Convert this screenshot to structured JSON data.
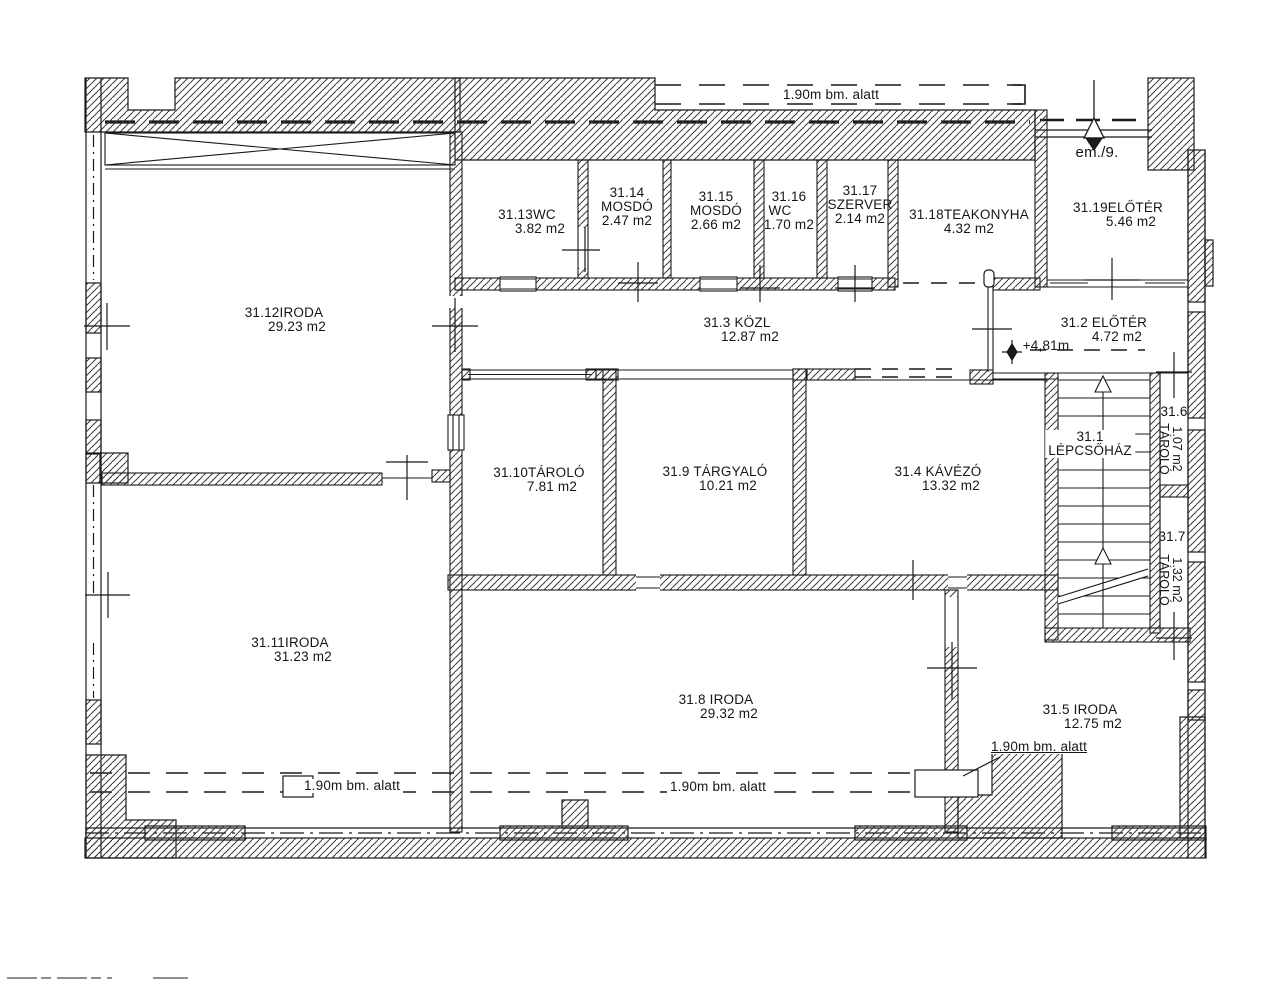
{
  "plan": {
    "rooms": [
      {
        "line1": "31.12IRODA",
        "area": "29.23 m2"
      },
      {
        "line1": "31.13WC",
        "area": "3.82 m2"
      },
      {
        "line1": "31.14",
        "line2": "MOSDÓ",
        "area": "2.47 m2"
      },
      {
        "line1": "31.15",
        "line2": "MOSDÓ",
        "area": "2.66 m2"
      },
      {
        "line1": "31.16",
        "line2": "WC",
        "area": "1.70 m2"
      },
      {
        "line1": "31.17",
        "line2": "SZERVER",
        "area": "2.14 m2"
      },
      {
        "line1": "31.18TEAKONYHA",
        "area": "4.32 m2"
      },
      {
        "line1": "31.19ELŐTÉR",
        "area": "5.46 m2"
      },
      {
        "line1": "31.3 KÖZL",
        "area": "12.87 m2"
      },
      {
        "line1": "31.2 ELŐTÉR",
        "area": "4.72 m2"
      },
      {
        "line1": "31.10TÁROLÓ",
        "area": "7.81 m2"
      },
      {
        "line1": "31.9 TÁRGYALÓ",
        "area": "10.21 m2"
      },
      {
        "line1": "31.4 KÁVÉZÓ",
        "area": "13.32 m2"
      },
      {
        "line1": "31.1",
        "line2": "LÉPCSŐHÁZ"
      },
      {
        "line1": "31.6",
        "name": "TÁROLÓ",
        "area": "1.07 m2"
      },
      {
        "line1": "31.7",
        "name": "TÁROLÓ",
        "area": "1.32 m2"
      },
      {
        "line1": "31.11IRODA",
        "area": "31.23 m2"
      },
      {
        "line1": "31.8 IRODA",
        "area": "29.32 m2"
      },
      {
        "line1": "31.5 IRODA",
        "area": "12.75 m2"
      }
    ],
    "annotations": {
      "height_note_top": "1.90m bm. alatt",
      "height_note_bottom_left": "1.90m bm. alatt",
      "height_note_bottom_mid": "1.90m bm. alatt",
      "height_note_bottom_right": "1.90m bm. alatt",
      "entrance_label": "em./9.",
      "elevation": "+4,81m"
    },
    "colors": {
      "ink": "#1a1a1a",
      "paper": "#ffffff"
    }
  }
}
